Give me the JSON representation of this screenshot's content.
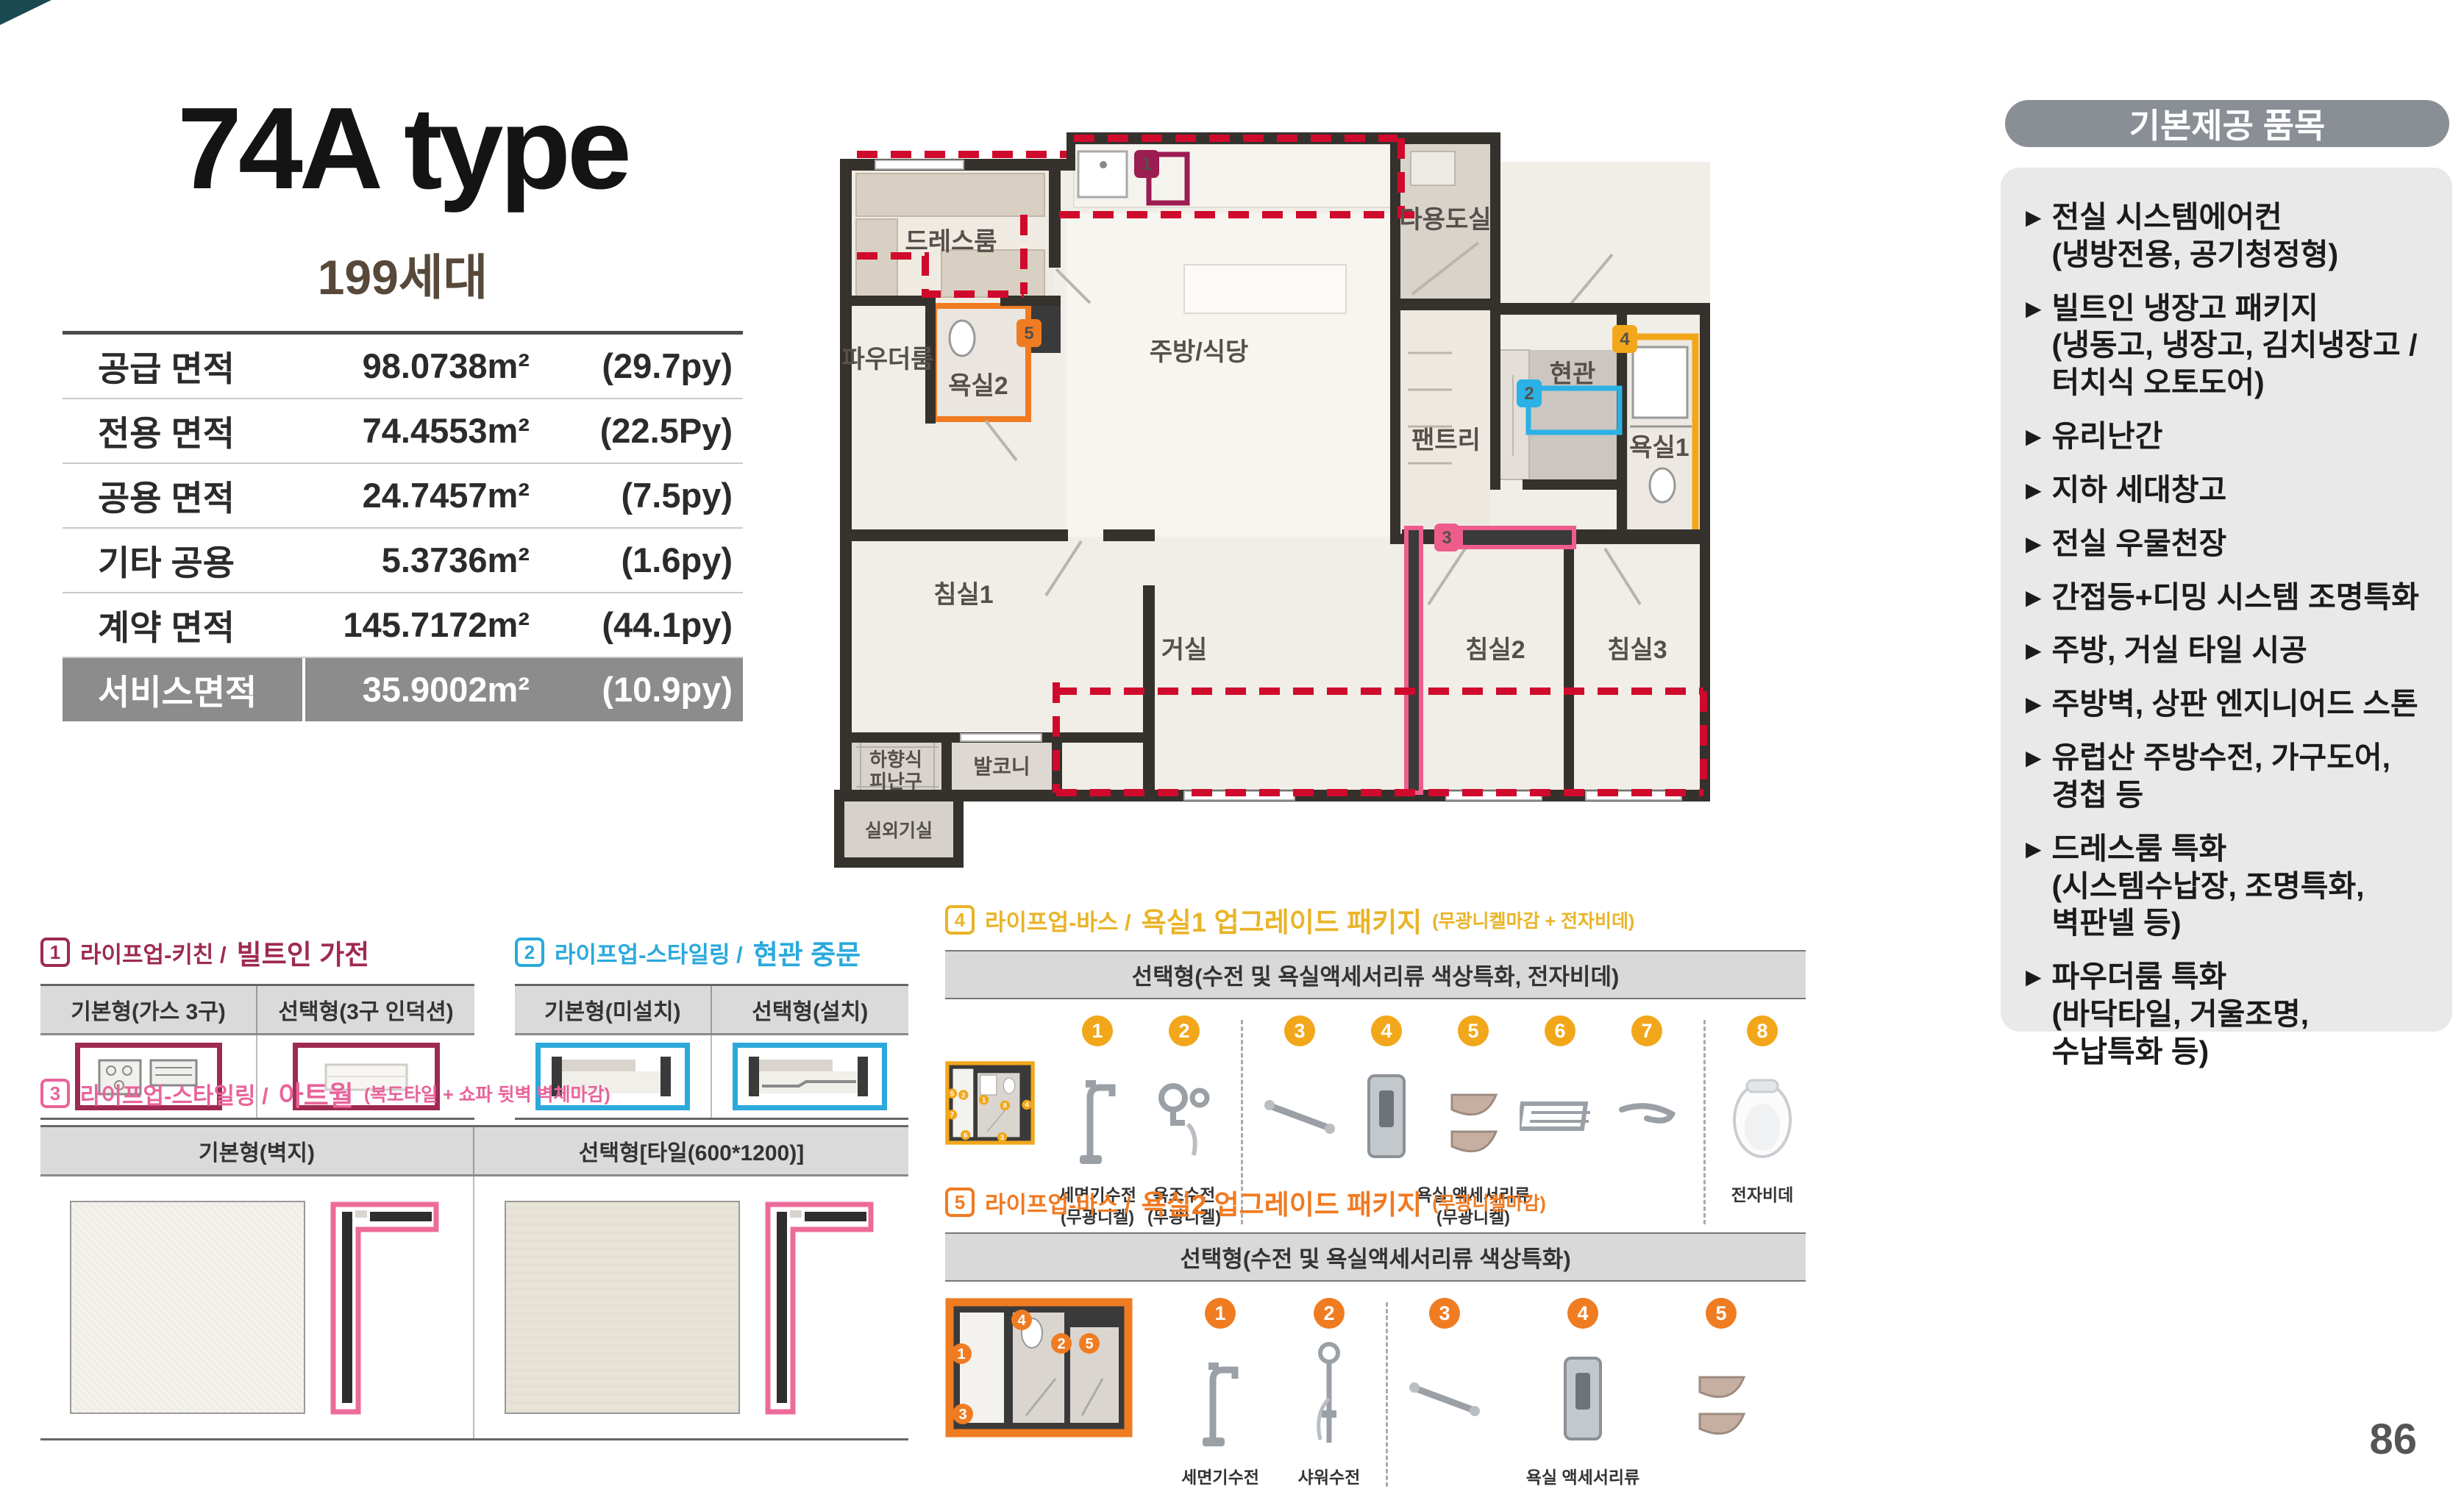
{
  "header": {
    "title": "74A type",
    "households": "199세대"
  },
  "area_table": {
    "rows": [
      {
        "label": "공급 면적",
        "value": "98.0738m²",
        "py": "(29.7py)"
      },
      {
        "label": "전용 면적",
        "value": "74.4553m²",
        "py": "(22.5Py)"
      },
      {
        "label": "공용 면적",
        "value": "24.7457m²",
        "py": "(7.5py)"
      },
      {
        "label": "기타 공용",
        "value": "5.3736m²",
        "py": "(1.6py)"
      },
      {
        "label": "계약 면적",
        "value": "145.7172m²",
        "py": "(44.1py)"
      },
      {
        "label": "서비스면적",
        "value": "35.9002m²",
        "py": "(10.9py)"
      }
    ]
  },
  "floor_plan": {
    "rooms": {
      "dress_room": "드레스룸",
      "powder_room": "파우더룸",
      "bath2": "욕실2",
      "kitchen_dining": "주방/식당",
      "utility": "다용도실",
      "pantry": "팬트리",
      "entrance": "현관",
      "bath1": "욕실1",
      "bedroom1": "침실1",
      "living": "거실",
      "bedroom2": "침실2",
      "bedroom3": "침실3",
      "escape_hatch_line1": "하향식",
      "escape_hatch_line2": "피난구",
      "balcony": "발코니",
      "ac_room": "실외기실"
    },
    "badges": {
      "b1": "1",
      "b2": "2",
      "b3": "3",
      "b4": "4",
      "b5": "5"
    }
  },
  "included": {
    "header": "기본제공 품목",
    "bullet": "▶",
    "items": [
      "전실 시스템에어컨\n(냉방전용, 공기청정형)",
      "빌트인 냉장고 패키지\n(냉동고, 냉장고, 김치냉장고 /\n터치식 오토도어)",
      "유리난간",
      "지하 세대창고",
      "전실 우물천장",
      "간접등+디밍 시스템 조명특화",
      "주방, 거실 타일 시공",
      "주방벽, 상판 엔지니어드 스톤",
      "유럽산 주방수전, 가구도어,\n경첩 등",
      "드레스룸 특화\n(시스템수납장, 조명특화,\n벽판넬 등)",
      "파우더룸 특화\n(바닥타일, 거울조명,\n수납특화 등)"
    ]
  },
  "options": {
    "kitchen": {
      "num": "1",
      "category": "라이프업-키친 /",
      "name": "빌트인 가전",
      "col1": "기본형(가스 3구)",
      "col2": "선택형(3구 인덕션)"
    },
    "middle_door": {
      "num": "2",
      "category": "라이프업-스타일링 /",
      "name": "현관 중문",
      "col1": "기본형(미설치)",
      "col2": "선택형(설치)"
    },
    "artwall": {
      "num": "3",
      "category": "라이프업-스타일링 /",
      "name": "아트월",
      "note": "(복도타일 + 쇼파 뒷벽 벽체마감)",
      "col1": "기본형(벽지)",
      "col2": "선택형[타일(600*1200)]"
    },
    "bath1": {
      "num": "4",
      "category": "라이프업-바스 /",
      "name": "욕실1 업그레이드 패키지",
      "note": "(무광니켈마감 + 전자비데)",
      "bar": "선택형(수전 및 욕실액세서리류 색상특화, 전자비데)",
      "group_label": "욕실 액세서리류\n(무광니켈)",
      "items": [
        {
          "num": "1",
          "label": "세면기수전\n(무광니켈)"
        },
        {
          "num": "2",
          "label": "욕조수전\n(무광니켈)"
        },
        {
          "num": "3"
        },
        {
          "num": "4"
        },
        {
          "num": "5"
        },
        {
          "num": "6"
        },
        {
          "num": "7"
        },
        {
          "num": "8",
          "label": "전자비데"
        }
      ]
    },
    "bath2": {
      "num": "5",
      "category": "라이프업-바스 /",
      "name": "욕실2 업그레이드 패키지",
      "note": "(무광니켈마감)",
      "bar": "선택형(수전 및 욕실액세서리류 색상특화)",
      "group_label": "욕실 액세서리류\n(무광니켈)",
      "items": [
        {
          "num": "1",
          "label": "세면기수전\n(무광니켈)"
        },
        {
          "num": "2",
          "label": "샤워수전\n(무광니켈)"
        },
        {
          "num": "3"
        },
        {
          "num": "4"
        },
        {
          "num": "5"
        }
      ]
    }
  },
  "colors": {
    "accent_maroon": "#9E2A52",
    "accent_pink": "#E8649B",
    "accent_cyan": "#2BA9DC",
    "accent_gold": "#F2A71B",
    "accent_orange": "#F07C22",
    "service_row_bg": "#8C8C8C",
    "sidebar_header_bg": "#8A8F96",
    "dash_red": "#CF0A2C"
  },
  "page_number": "86"
}
